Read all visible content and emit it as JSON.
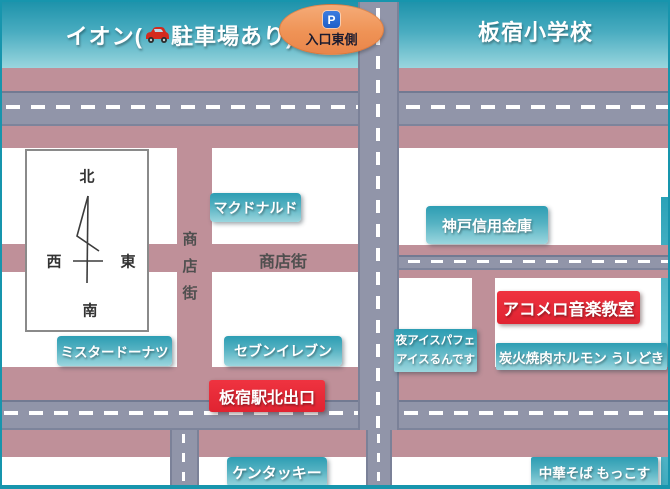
{
  "map": {
    "buildings": {
      "ion": {
        "prefix": "イオン(",
        "suffix": "駐車場あり)"
      },
      "school": {
        "label": "板宿小学校"
      }
    },
    "entrance_badge": {
      "icon": "P",
      "label": "入口東側"
    },
    "roads": {
      "shotengai_horizontal": "商店街",
      "shotengai_vertical": [
        "商",
        "店",
        "街"
      ]
    },
    "compass": {
      "north": "北",
      "south": "南",
      "east": "東",
      "west": "西"
    },
    "places": {
      "mcdonalds": "マクドナルド",
      "kobe_shinkin_bank": "神戸信用金庫",
      "mister_donut": "ミスタードーナツ",
      "seven_eleven": "セブンイレブン",
      "night_ice_line1": "夜アイスパフェ",
      "night_ice_line2": "アイスるんです",
      "yakiniku_ushidoki": "炭火焼肉ホルモン うしどき",
      "kfc": "ケンタッキー",
      "mokkosu": "中華そば もっこす"
    },
    "destinations": {
      "acomelo": "アコメロ音楽教室",
      "station_exit": "板宿駅北出口"
    },
    "colors": {
      "building_teal_top": "#1e93ab",
      "building_teal_bottom": "#9ad6de",
      "road_mauve": "#bf9099",
      "road_gray": "#9195a9",
      "highlight_red": "#e62735",
      "badge_orange": "#ef9356",
      "parking_blue": "#2a6fd8",
      "border_teal": "#1795ad"
    }
  }
}
